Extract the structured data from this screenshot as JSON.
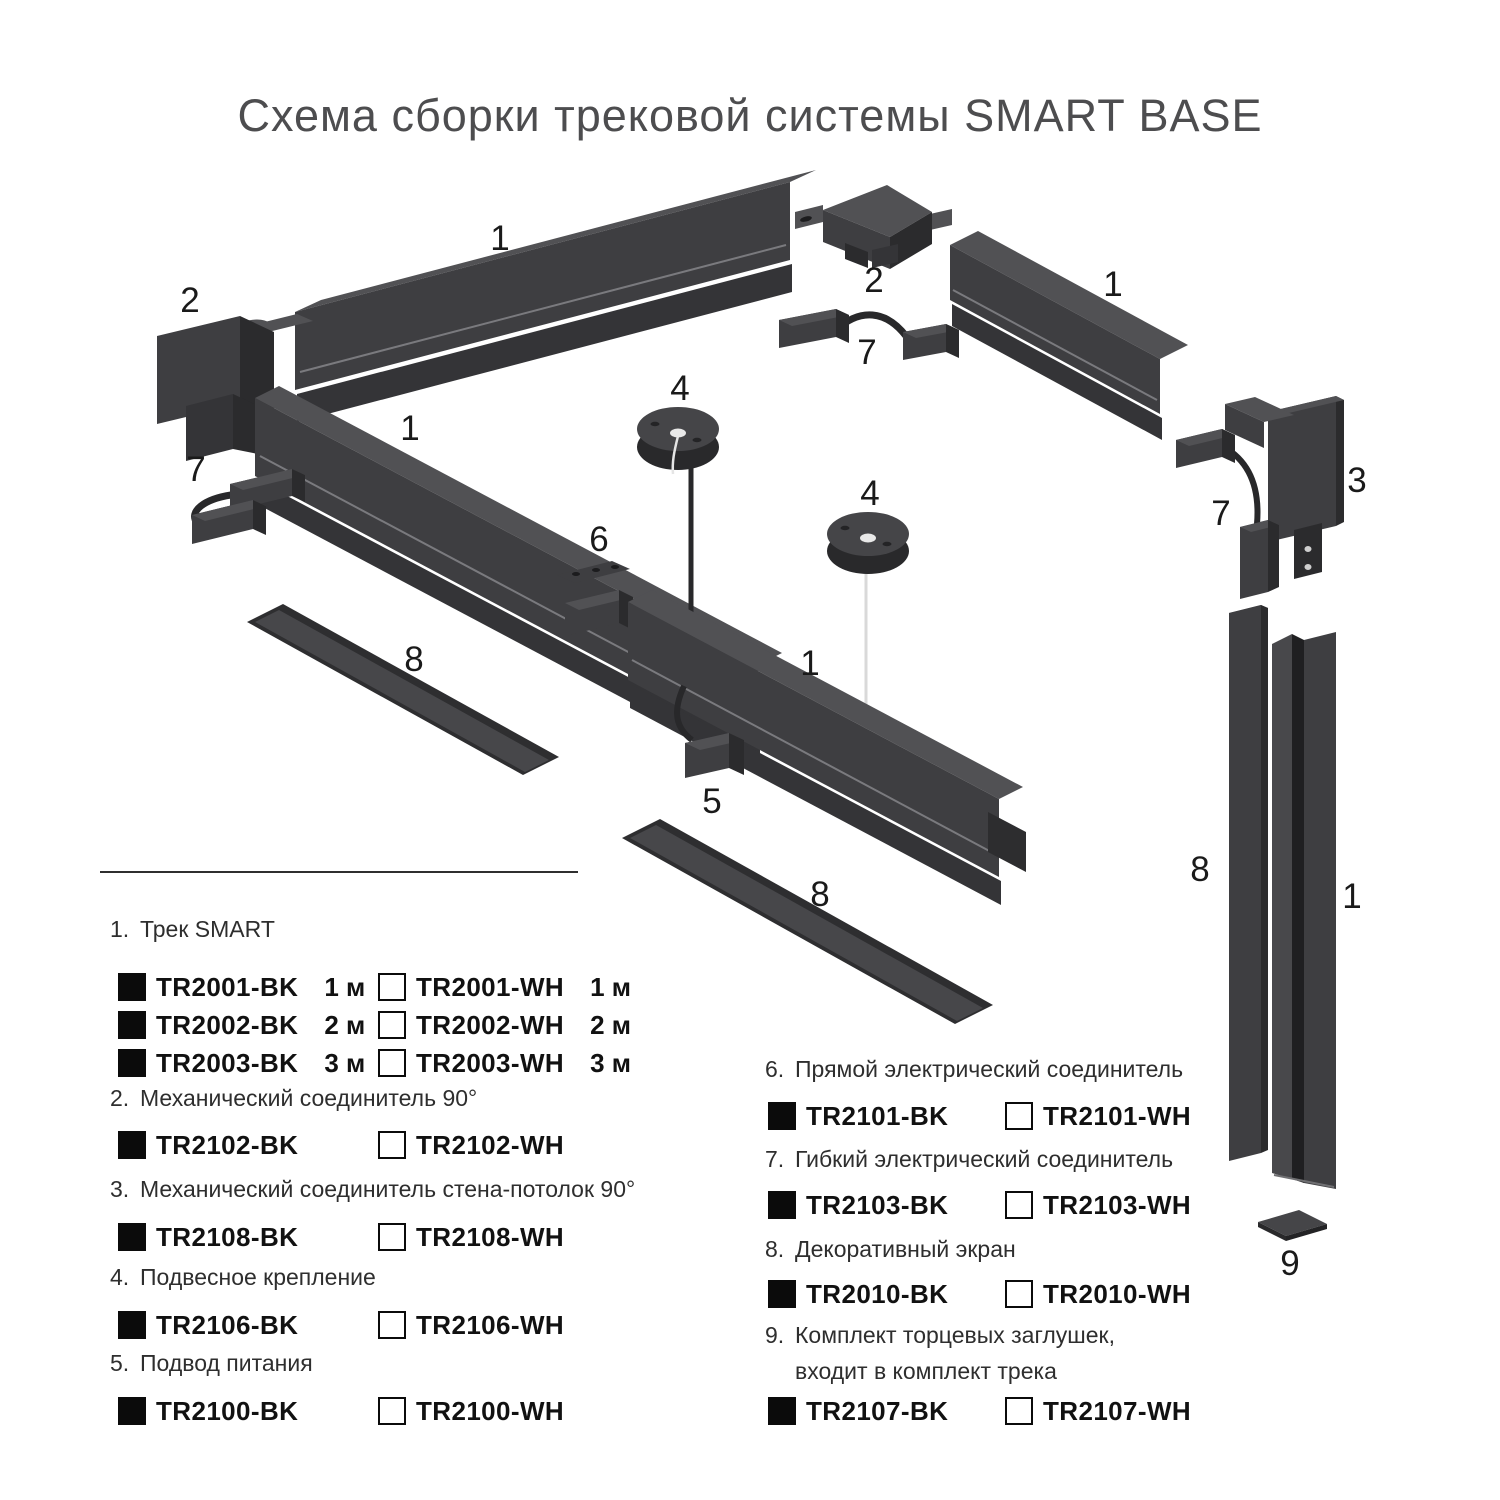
{
  "title": "Схема сборки трековой системы SMART BASE",
  "colors": {
    "title_text": "#4d4d4f",
    "part_front": "#3e3e41",
    "part_top": "#515154",
    "part_side": "#2b2b2d",
    "swatch_black": "#0b0b0b",
    "swatch_white": "#ffffff",
    "legend_text": "#2e2e2e",
    "code_text": "#111111"
  },
  "diagram": {
    "labels": {
      "track_top_left": "1",
      "corner_left": "2",
      "track_left": "1",
      "flex_left": "7",
      "corner_top": "2",
      "flex_top": "7",
      "track_top_right": "1",
      "pendant_left": "4",
      "pendant_right": "4",
      "connector_straight": "6",
      "track_middle": "1",
      "power_feed": "5",
      "screen_left": "8",
      "screen_middle": "8",
      "corner_wall": "3",
      "flex_right": "7",
      "screen_vertical": "8",
      "track_vertical": "1",
      "end_cap": "9"
    }
  },
  "legend": {
    "left": [
      {
        "num": "1.",
        "title": "Трек SMART",
        "rows": [
          {
            "bk_code": "TR2001-BK",
            "bk_len": "1 м",
            "wh_code": "TR2001-WH",
            "wh_len": "1 м"
          },
          {
            "bk_code": "TR2002-BK",
            "bk_len": "2 м",
            "wh_code": "TR2002-WH",
            "wh_len": "2 м"
          },
          {
            "bk_code": "TR2003-BK",
            "bk_len": "3 м",
            "wh_code": "TR2003-WH",
            "wh_len": "3 м"
          }
        ]
      },
      {
        "num": "2.",
        "title": "Механический соединитель 90°",
        "rows": [
          {
            "bk_code": "TR2102-BK",
            "bk_len": "",
            "wh_code": "TR2102-WH",
            "wh_len": ""
          }
        ]
      },
      {
        "num": "3.",
        "title": "Механический соединитель стена-потолок 90°",
        "rows": [
          {
            "bk_code": "TR2108-BK",
            "bk_len": "",
            "wh_code": "TR2108-WH",
            "wh_len": ""
          }
        ]
      },
      {
        "num": "4.",
        "title": "Подвесное крепление",
        "rows": [
          {
            "bk_code": "TR2106-BK",
            "bk_len": "",
            "wh_code": "TR2106-WH",
            "wh_len": ""
          }
        ]
      },
      {
        "num": "5.",
        "title": "Подвод питания",
        "rows": [
          {
            "bk_code": "TR2100-BK",
            "bk_len": "",
            "wh_code": "TR2100-WH",
            "wh_len": ""
          }
        ]
      }
    ],
    "right": [
      {
        "num": "6.",
        "title": "Прямой электрический соединитель",
        "rows": [
          {
            "bk_code": "TR2101-BK",
            "wh_code": "TR2101-WH"
          }
        ]
      },
      {
        "num": "7.",
        "title": "Гибкий электрический соединитель",
        "rows": [
          {
            "bk_code": "TR2103-BK",
            "wh_code": "TR2103-WH"
          }
        ]
      },
      {
        "num": "8.",
        "title": "Декоративный экран",
        "rows": [
          {
            "bk_code": "TR2010-BK",
            "wh_code": "TR2010-WH"
          }
        ]
      },
      {
        "num": "9.",
        "title": "Комплект торцевых заглушек,",
        "title2": "входит в комплект трека",
        "rows": [
          {
            "bk_code": "TR2107-BK",
            "wh_code": "TR2107-WH"
          }
        ]
      }
    ]
  }
}
